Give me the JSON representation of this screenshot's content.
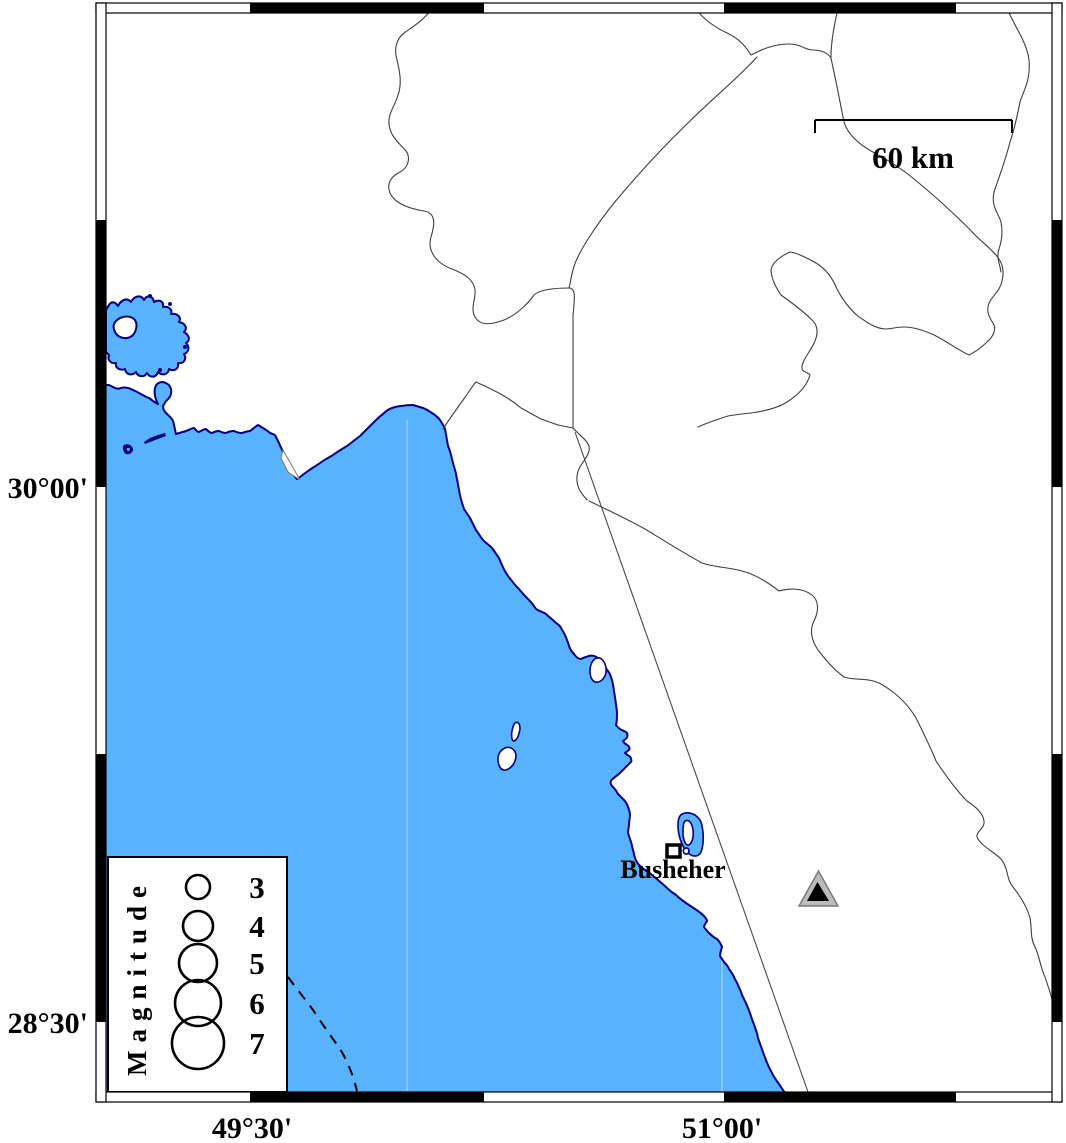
{
  "map": {
    "city_label": "Busheher",
    "scale_label": "60 km",
    "lat_labels": [
      "30°00'",
      "28°30'"
    ],
    "lon_labels": [
      "49°30'",
      "51°00'"
    ],
    "legend": {
      "title": "Magnitude",
      "magnitudes": [
        "3",
        "4",
        "5",
        "6",
        "7"
      ]
    },
    "colors": {
      "sea": "#58b2fc",
      "coastline": "#000082",
      "land": "#ffffff",
      "boundary": "#3e3e3e",
      "station_fill": "#bcbcbc",
      "station_core": "#000000"
    }
  }
}
